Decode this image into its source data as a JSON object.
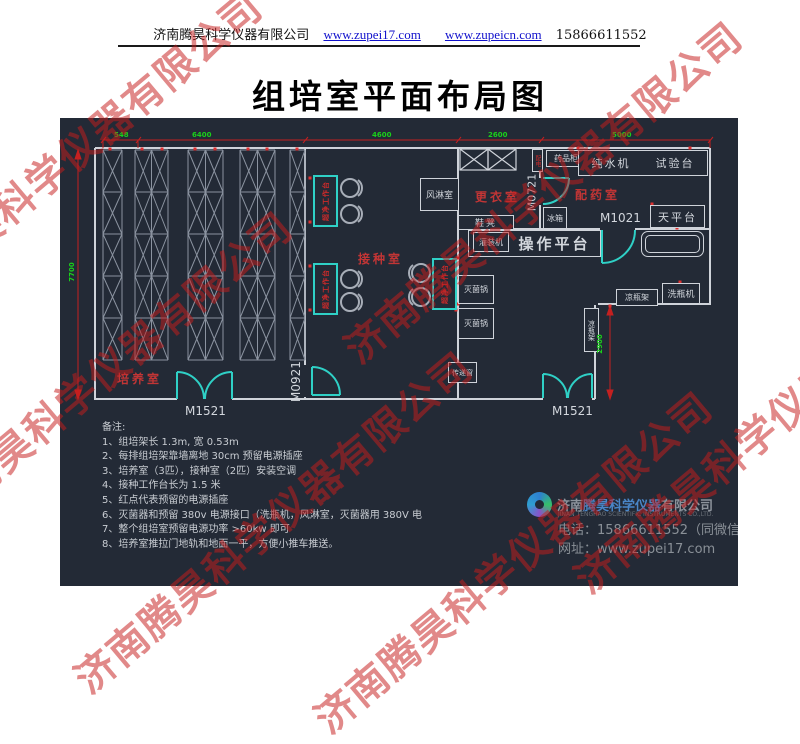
{
  "header": {
    "company": "济南腾昊科学仪器有限公司",
    "url1": "www.zupei17.com",
    "url2": "www.zupeicn.com",
    "phone": "15866611552"
  },
  "title": "组培室平面布局图",
  "watermark": {
    "text": "济南腾昊科学仪器有限公司",
    "color": "#c61c1c"
  },
  "plan": {
    "dims": {
      "top": [
        "548",
        "6400",
        "4600",
        "2600",
        "5000"
      ],
      "left": "7700",
      "right": "2900"
    },
    "rooms": {
      "culture": "培养室",
      "inoculation": "接种室",
      "changing": "更衣室",
      "dispensing": "配药室"
    },
    "doors": {
      "m1521": "M1521",
      "m0921": "M0921",
      "m0721": "M0721",
      "m1021": "M1021"
    },
    "equipment": {
      "air_shower": "风淋室",
      "power_box": "配电",
      "medicine_cabinet": "药品柜",
      "water_machine": "纯水机",
      "test_bench": "试验台",
      "balance": "天平台",
      "fridge": "冰箱",
      "shoe_bench": "鞋凳",
      "filling_machine": "灌装机",
      "operation_platform": "操作平台",
      "sterilizer": "灭菌锅",
      "pass_window": "传递窗",
      "bottle_rack": "凉瓶架",
      "bottle_washer": "洗瓶机",
      "clean_bench": "超净工作台"
    },
    "colors": {
      "canvas_bg": "#232a36",
      "wall": "#cfd3da",
      "door": "#2fd0c6",
      "dim_line": "#c42020",
      "dim_text": "#1ad11a",
      "room_label": "#c23535",
      "socket_dot": "#e03030"
    }
  },
  "notes": {
    "title": "备注:",
    "items": [
      "1、组培架长 1.3m, 宽 0.53m",
      "2、每排组培架靠墙离地 30cm 预留电源插座",
      "3、培养室（3匹），接种室（2匹）安装空调",
      "4、接种工作台长为 1.5 米",
      "5、红点代表预留的电源插座",
      "6、灭菌器和预留 380v 电源接口（洗瓶机，风淋室，灭菌器用 380V 电",
      "7、整个组培室预留电源功率 >60kw 即可",
      "8、培养室推拉门地轨和地面一平，方便小推车推送。"
    ]
  },
  "footer": {
    "company_prefix": "济南",
    "company_brand": "腾昊科学仪器",
    "company_suffix": "有限公司",
    "company_en": "JINAN TENGHAO SCIENTIFIC INSTRUMENTS CO.,LTD.",
    "phone_line": "电话：15866611552（同微信）",
    "site_line": "网址：www.zupei17.com"
  }
}
